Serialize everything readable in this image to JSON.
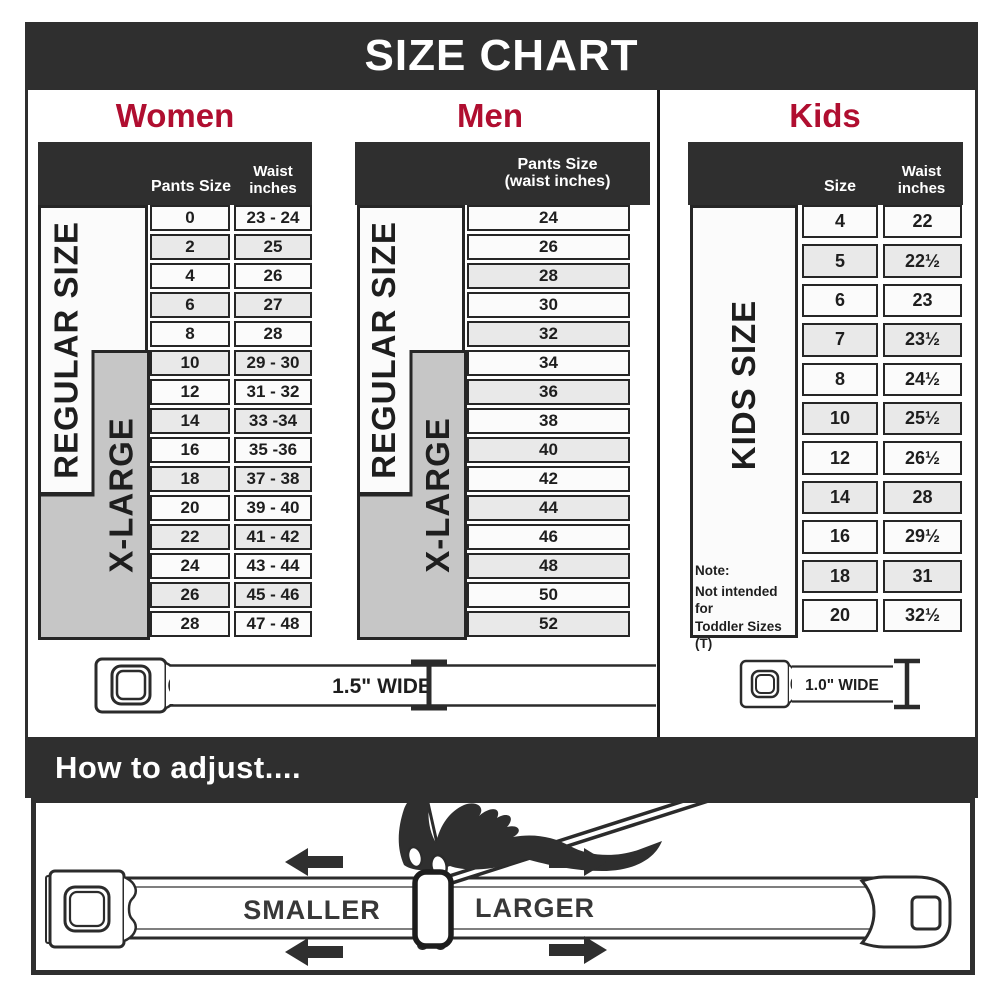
{
  "title": "SIZE CHART",
  "colors": {
    "accent": "#B00E30",
    "dark": "#2F2F2F",
    "row_alt": "#E9E9E9",
    "xlarge_gray": "#C6C6C6"
  },
  "sections": {
    "women": {
      "heading": "Women",
      "col1_header": "Pants Size",
      "col2_header_line1": "Waist",
      "col2_header_line2": "inches",
      "regular_label": "REGULAR SIZE",
      "xlarge_label": "X-LARGE",
      "rows": [
        {
          "size": "0",
          "waist": "23 - 24"
        },
        {
          "size": "2",
          "waist": "25"
        },
        {
          "size": "4",
          "waist": "26"
        },
        {
          "size": "6",
          "waist": "27"
        },
        {
          "size": "8",
          "waist": "28"
        },
        {
          "size": "10",
          "waist": "29 - 30"
        },
        {
          "size": "12",
          "waist": "31 - 32"
        },
        {
          "size": "14",
          "waist": "33 -34"
        },
        {
          "size": "16",
          "waist": "35 -36"
        },
        {
          "size": "18",
          "waist": "37 - 38"
        },
        {
          "size": "20",
          "waist": "39 - 40"
        },
        {
          "size": "22",
          "waist": "41 - 42"
        },
        {
          "size": "24",
          "waist": "43 - 44"
        },
        {
          "size": "26",
          "waist": "45 - 46"
        },
        {
          "size": "28",
          "waist": "47 - 48"
        }
      ]
    },
    "men": {
      "heading": "Men",
      "col_header_line1": "Pants Size",
      "col_header_line2": "(waist inches)",
      "regular_label": "REGULAR SIZE",
      "xlarge_label": "X-LARGE",
      "rows": [
        "24",
        "26",
        "28",
        "30",
        "32",
        "34",
        "36",
        "38",
        "40",
        "42",
        "44",
        "46",
        "48",
        "50",
        "52"
      ]
    },
    "kids": {
      "heading": "Kids",
      "col1_header": "Size",
      "col2_header_line1": "Waist",
      "col2_header_line2": "inches",
      "side_label": "KIDS SIZE",
      "note_line1": "Note:",
      "note_line2": "Not intended for",
      "note_line3": "Toddler Sizes (T)",
      "rows": [
        {
          "size": "4",
          "waist": "22"
        },
        {
          "size": "5",
          "waist": "22½"
        },
        {
          "size": "6",
          "waist": "23"
        },
        {
          "size": "7",
          "waist": "23½"
        },
        {
          "size": "8",
          "waist": "24½"
        },
        {
          "size": "10",
          "waist": "25½"
        },
        {
          "size": "12",
          "waist": "26½"
        },
        {
          "size": "14",
          "waist": "28"
        },
        {
          "size": "16",
          "waist": "29½"
        },
        {
          "size": "18",
          "waist": "31"
        },
        {
          "size": "20",
          "waist": "32½"
        }
      ]
    }
  },
  "belts": {
    "adult_width_label": "1.5\" WIDE",
    "kids_width_label": "1.0\" WIDE"
  },
  "how_to_adjust": {
    "heading": "How to adjust....",
    "smaller_label": "SMALLER",
    "larger_label": "LARGER"
  }
}
